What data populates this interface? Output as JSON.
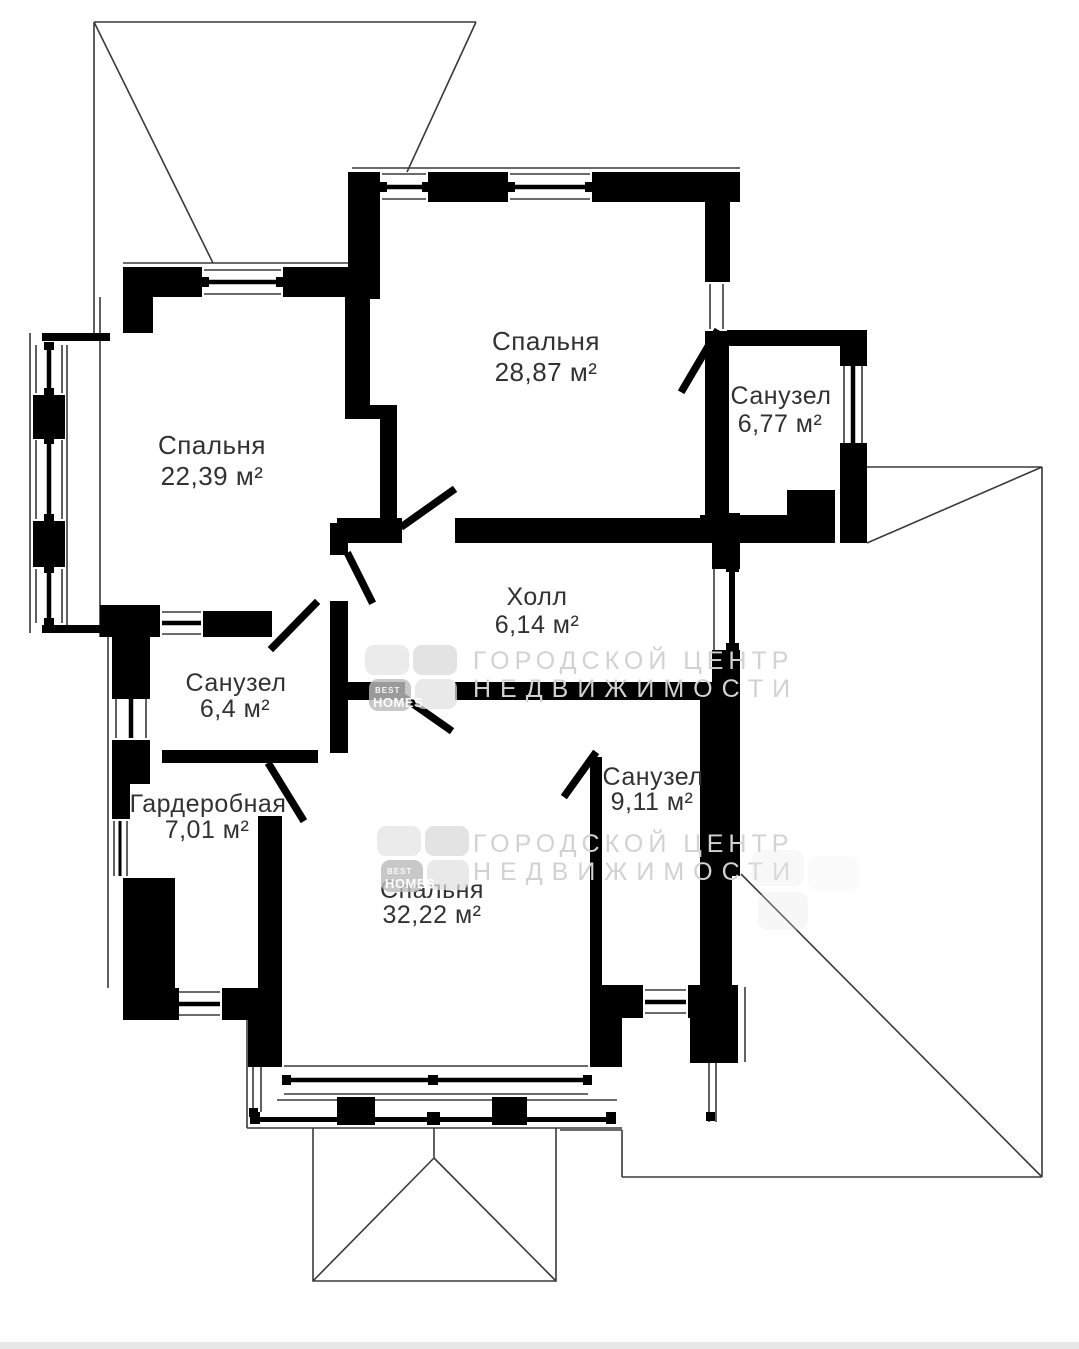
{
  "plan": {
    "title": "floor-plan",
    "rooms": [
      {
        "key": "bedroom-top",
        "name": "Спальня",
        "area": "28,87 м²"
      },
      {
        "key": "bathroom-top-right",
        "name": "Санузел",
        "area": "6,77 м²"
      },
      {
        "key": "bedroom-left",
        "name": "Спальня",
        "area": "22,39 м²"
      },
      {
        "key": "hall",
        "name": "Холл",
        "area": "6,14 м²"
      },
      {
        "key": "bathroom-mid-left",
        "name": "Санузел",
        "area": "6,4 м²"
      },
      {
        "key": "wardrobe",
        "name": "Гардеробная",
        "area": "7,01 м²"
      },
      {
        "key": "bathroom-bottom-right",
        "name": "Санузел",
        "area": "9,11 м²"
      },
      {
        "key": "bedroom-bottom",
        "name": "Спальня",
        "area": "32,22 м²"
      }
    ]
  },
  "watermark": {
    "line1": "ГОРОДСКОЙ ЦЕНТР",
    "line2": "НЕДВИЖИМОСТИ",
    "logo_top": "BEST",
    "logo_bottom": "HOMES"
  },
  "colors": {
    "wall": "#000000",
    "thin_line": "#3a3a3a",
    "label": "#323232",
    "watermark_text": "#d2d2d2"
  }
}
